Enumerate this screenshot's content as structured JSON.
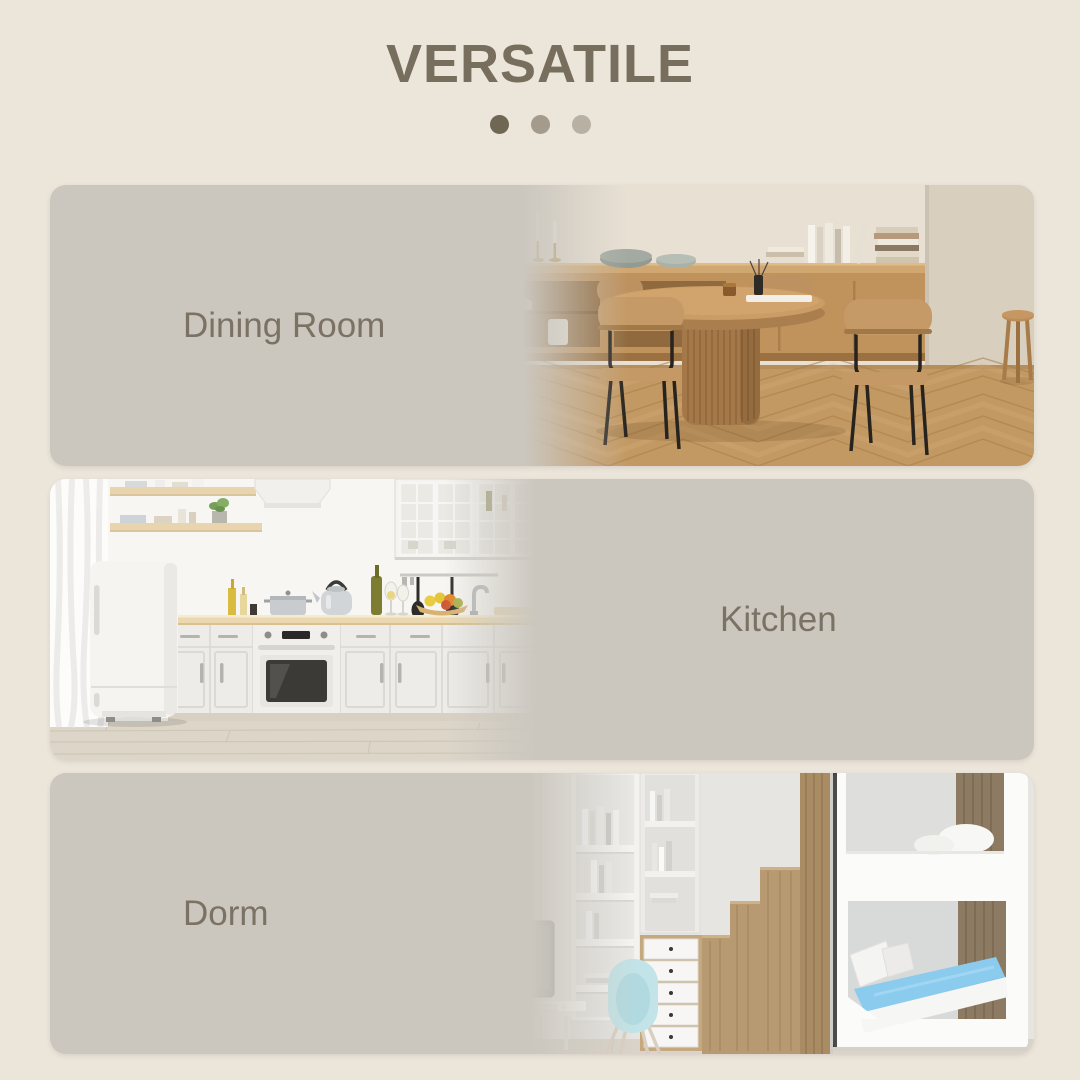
{
  "header": {
    "title": "VERSATILE"
  },
  "pagination_dots": {
    "count": 3,
    "active_index": 0,
    "colors": [
      "#6f6654",
      "#a49b8c",
      "#b8b0a3"
    ]
  },
  "panels": [
    {
      "label": "Dining Room",
      "image": "dining-room-photo",
      "image_side": "right"
    },
    {
      "label": "Kitchen",
      "image": "kitchen-photo",
      "image_side": "left"
    },
    {
      "label": "Dorm",
      "image": "dorm-photo",
      "image_side": "right"
    }
  ],
  "colors": {
    "bg": "#ebe5da",
    "panel": "#cbc7bf",
    "panel_t": "rgba(203,199,191,0)",
    "title": "#776e5e",
    "label": "#7b7264",
    "dot1": "#6f6654",
    "dot2": "#a49b8c",
    "dot3": "#b8b0a3"
  }
}
